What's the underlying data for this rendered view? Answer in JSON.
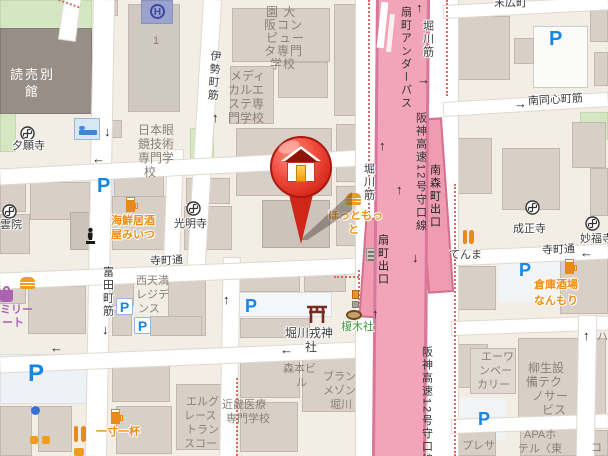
{
  "map": {
    "marker": {
      "type": "home-pin"
    },
    "streets": {
      "isemachi": "伊勢町筋",
      "teramachi_w": "寺町通",
      "teramachi_e": "寺町通",
      "minamidoshin": "南同心町筋",
      "suehirocho": "末広町",
      "tomita": "富田町筋",
      "horikawa_a": "堀川筋",
      "horikawa_b": "堀川筋",
      "underpass": "扇町アンダーパス",
      "hanshin1": "阪神高速12号守口線",
      "hanshin2": "阪神高速12号守口線",
      "exit_minamimorimachi": "南森町出口",
      "exit_ogimachi": "扇町出口"
    },
    "places": {
      "yomiuri": [
        "読売別",
        "館"
      ],
      "heli_building_no": "1",
      "osaka_computer": [
        "園 大",
        "阪コン",
        "ピュー",
        "タ専門",
        "学校"
      ],
      "medical_esthe": [
        "メディ",
        "カルエ",
        "ステ専",
        "門学校"
      ],
      "nihon_gankyo": [
        "日本眼",
        "鏡技術",
        "専門学",
        "校"
      ],
      "yuganji": "夕願寺",
      "unin": "雲院",
      "komyoji": "光明寺",
      "kaisen_izakaya": [
        "海鮮居酒",
        "屋みいつ"
      ],
      "hottomotto": [
        "ほっともっ",
        "と"
      ],
      "nishitenma_residence": [
        "西天満",
        "レジデ",
        "ンス"
      ],
      "familymart_partial": [
        "ミリー",
        "ート"
      ],
      "horikawa_ebisu": [
        "堀川戎神",
        "社"
      ],
      "enokisha": "榎木社",
      "morimoto_bldg": [
        "森本ビ",
        "ル"
      ],
      "blanc_maison": [
        "ブラン",
        "メゾン",
        "堀川"
      ],
      "kinki_medical": [
        "近畿医療",
        "専門学校"
      ],
      "elgrace": [
        "エルグ",
        "レース",
        "トラン",
        "スコー"
      ],
      "issun_ippai": "一寸一杯",
      "aone_bakery": [
        "エーワ",
        "ンベー",
        "カリー"
      ],
      "yagyu_setsubi": [
        "柳生設",
        "備テク",
        "ノサー",
        "ビス"
      ],
      "apa_hotel": [
        "APAホ",
        "テル〈東"
      ],
      "presa": "プレサ",
      "tenma": "てんま",
      "seishoji": "成正寺",
      "myofukuji": "妙福寺",
      "soko_sakaba": [
        "倉庫酒場",
        "なんもり"
      ]
    },
    "icons": {
      "parking": "P",
      "helipad": "H",
      "edge_fragment_1": "ハ",
      "edge_fragment_2": "コ"
    },
    "arrows": {
      "up": "↑",
      "down": "↓",
      "left": "←",
      "right": "→"
    },
    "colors": {
      "highway_pink": "#f2a4b8",
      "parking_blue": "#1486e8",
      "poi_orange": "#ef8d10",
      "shrine_green": "#3f9a3c",
      "boundary_red": "#e0665f",
      "pin_red": "#e03325"
    }
  }
}
